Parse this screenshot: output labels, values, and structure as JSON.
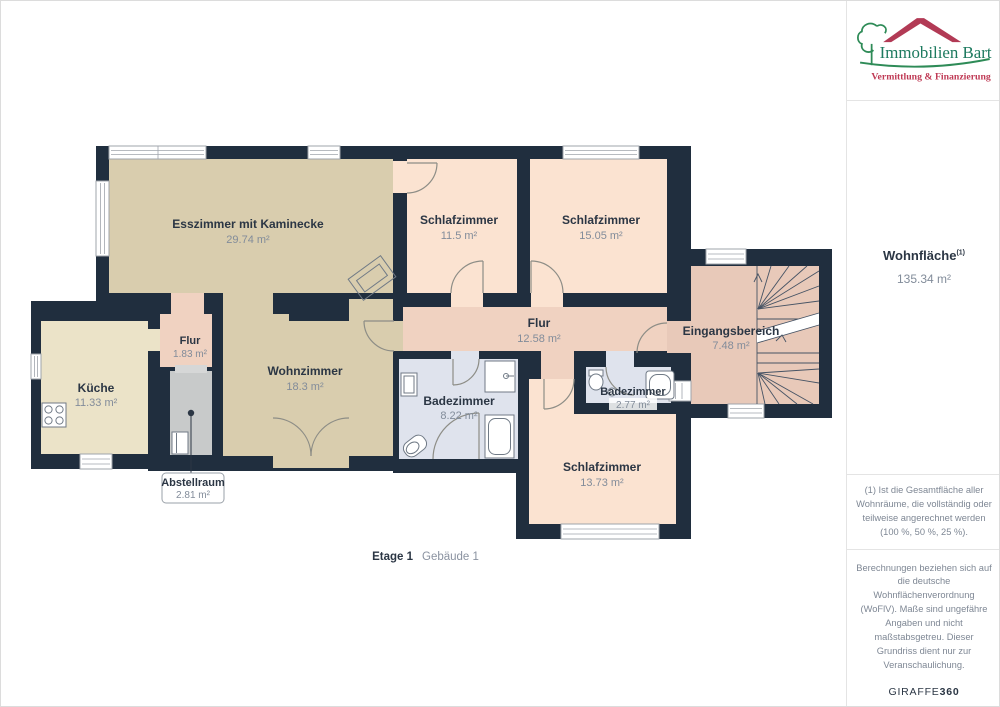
{
  "branding": {
    "company": "Immobilien Bart",
    "tagline": "Vermittlung & Finanzierung"
  },
  "sidebar": {
    "area_label": "Wohnfläche",
    "area_footnote_marker": "(1)",
    "total_area": "135.34 m²",
    "footnote": "(1) Ist die Gesamtfläche aller Wohnräume, die vollständig oder teilweise angerechnet werden (100 %, 50 %, 25 %).",
    "disclaimer": "Berechnungen beziehen sich auf die deutsche Wohnflächenverordnung (WoFlV). Maße sind ungefähre Angaben und nicht maßstabsgetreu. Dieser Grundriss dient nur zur Veranschaulichung.",
    "brand": "GIRAFFE",
    "brand_suffix": "360"
  },
  "plan": {
    "floor_label": "Etage 1",
    "building_label": "Gebäude 1",
    "rooms": [
      {
        "name": "Esszimmer mit Kaminecke",
        "area": "29.74 m²"
      },
      {
        "name": "Schlafzimmer",
        "area": "11.5 m²"
      },
      {
        "name": "Schlafzimmer",
        "area": "15.05 m²"
      },
      {
        "name": "Flur",
        "area": "12.58 m²"
      },
      {
        "name": "Eingangsbereich",
        "area": "7.48 m²"
      },
      {
        "name": "Küche",
        "area": "11.33 m²"
      },
      {
        "name": "Flur",
        "area": "1.83 m²"
      },
      {
        "name": "Wohnzimmer",
        "area": "18.3 m²"
      },
      {
        "name": "Badezimmer",
        "area": "8.22 m²"
      },
      {
        "name": "Badezimmer",
        "area": "2.77 m²"
      },
      {
        "name": "Schlafzimmer",
        "area": "13.73 m²"
      },
      {
        "name": "Abstellraum",
        "area": "2.81 m²"
      }
    ]
  },
  "colors": {
    "wall": "#202e3e",
    "living_floor": "#d9cdae",
    "bedroom_floor": "#fbe3d1",
    "hall_floor": "#f0d2c1",
    "entry_floor": "#e8c9b9",
    "kitchen_floor": "#ebe3c8",
    "bath_floor": "#dfe3ed",
    "storage_floor": "#c8caca",
    "brand_green": "#1d7a5f",
    "brand_red": "#bf3a55"
  }
}
